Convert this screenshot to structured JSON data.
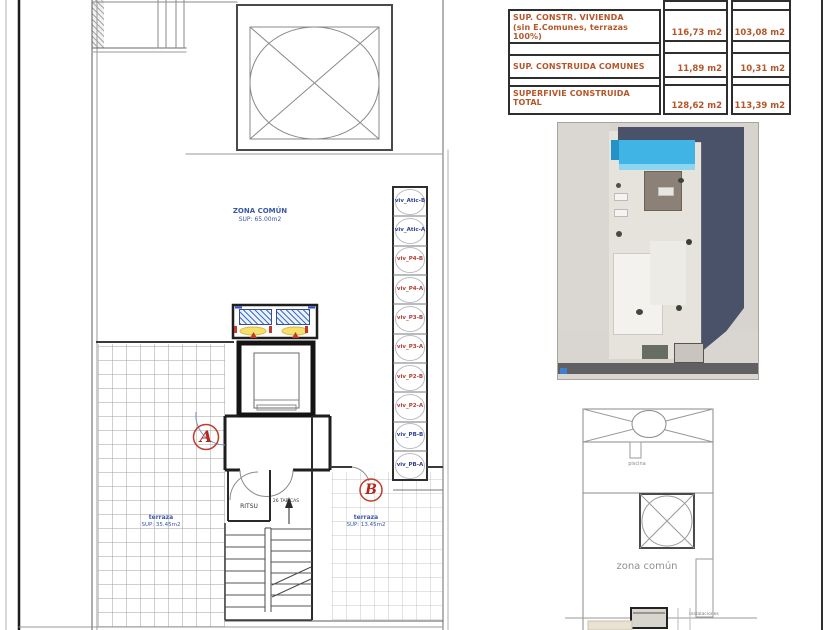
{
  "area_table": {
    "rows": [
      {
        "label": "SUP. CONSTR. VIVIENDA",
        "label2": "(sin E.Comunes, terrazas 100%)",
        "value_a": "116,73 m2",
        "value_b": "103,08 m2"
      },
      {
        "label": "SUP. CONSTRUIDA COMUNES",
        "label2": "",
        "value_a": "11,89 m2",
        "value_b": "10,31 m2"
      },
      {
        "label": "SUPERFIVIE CONSTRUIDA",
        "label2": "TOTAL",
        "value_a": "128,62 m2",
        "value_b": "113,39 m2"
      }
    ],
    "text_color": "#b5562a"
  },
  "floor_plan": {
    "zona_comun": {
      "title": "ZONA COMÚN",
      "sup": "SUP: 65.00m2"
    },
    "terraza_left": {
      "title": "terraza",
      "sup": "SUP: 35.45m2"
    },
    "terraza_right": {
      "title": "terraza",
      "sup": "SUP: 13.45m2"
    },
    "ritsu": "RITSU",
    "tabicas": "26 TABICAS",
    "marker_a": "A",
    "marker_b": "B",
    "units": [
      {
        "text": "viv_Atic-B",
        "color": "#2c3f93"
      },
      {
        "text": "viv_Atic-A",
        "color": "#2c3f93"
      },
      {
        "text": "viv_P4-B",
        "color": "#b03a30"
      },
      {
        "text": "viv_P4-A",
        "color": "#b03a30"
      },
      {
        "text": "viv_P3-B",
        "color": "#b03a30"
      },
      {
        "text": "viv_P3-A",
        "color": "#b03a30"
      },
      {
        "text": "viv_P2-B",
        "color": "#b03a30"
      },
      {
        "text": "viv_P2-A",
        "color": "#b03a30"
      },
      {
        "text": "viv_PB-B",
        "color": "#2c3f93"
      },
      {
        "text": "viv_PB-A",
        "color": "#2c3f93"
      }
    ]
  },
  "mini_plan": {
    "piscina": "piscina",
    "zona_comun": "zona común",
    "instalaciones": "instalaciones"
  },
  "colors": {
    "annotation_blue": "#3a57a8",
    "marker_red": "#c0392b",
    "pool_blue": "#41b4e6",
    "shadow_navy": "#4a5269",
    "table_text": "#b5562a"
  }
}
